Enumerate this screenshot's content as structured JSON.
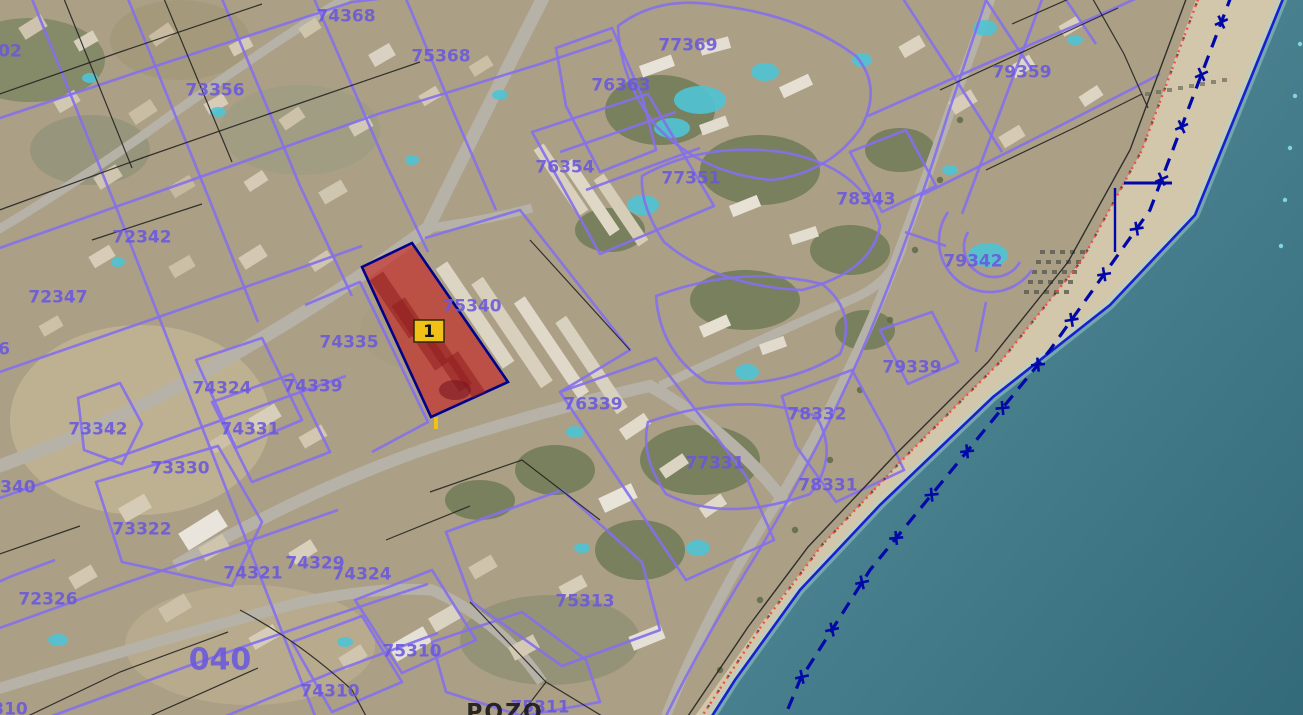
{
  "map": {
    "description": "Cadastral parcel map over aerial photo, coastal urban area",
    "marker": {
      "label": "1",
      "x": 429,
      "y": 331,
      "box_w": 30,
      "box_h": 22,
      "bg": "#f2c118",
      "border": "#2e2800",
      "text_color": "#111111"
    },
    "selected_parcel": {
      "number": "75340",
      "fill": "#c62020",
      "fill_opacity": 0.62,
      "border_color": "#00008b",
      "points": [
        [
          362,
          267
        ],
        [
          412,
          243
        ],
        [
          508,
          382
        ],
        [
          431,
          417
        ]
      ],
      "stem": [
        436,
        417,
        436,
        429
      ]
    },
    "labels": [
      {
        "text": "74368",
        "x": 346,
        "y": 15
      },
      {
        "text": "75368",
        "x": 441,
        "y": 55
      },
      {
        "text": "73356",
        "x": 215,
        "y": 89
      },
      {
        "text": "77369",
        "x": 688,
        "y": 44
      },
      {
        "text": "76363",
        "x": 621,
        "y": 84
      },
      {
        "text": "79359",
        "x": 1022,
        "y": 71
      },
      {
        "text": "72342",
        "x": 142,
        "y": 236
      },
      {
        "text": "72347",
        "x": 58,
        "y": 296
      },
      {
        "text": "76354",
        "x": 565,
        "y": 166
      },
      {
        "text": "77351",
        "x": 691,
        "y": 177
      },
      {
        "text": "78343",
        "x": 866,
        "y": 198
      },
      {
        "text": "79342",
        "x": 973,
        "y": 260
      },
      {
        "text": "75340",
        "x": 472,
        "y": 305
      },
      {
        "text": "74335",
        "x": 349,
        "y": 341
      },
      {
        "text": "74324",
        "x": 222,
        "y": 387
      },
      {
        "text": "74339",
        "x": 313,
        "y": 385
      },
      {
        "text": "79339",
        "x": 912,
        "y": 366
      },
      {
        "text": "76339",
        "x": 593,
        "y": 403
      },
      {
        "text": "78332",
        "x": 817,
        "y": 413
      },
      {
        "text": "73342",
        "x": 98,
        "y": 428
      },
      {
        "text": "74331",
        "x": 250,
        "y": 428
      },
      {
        "text": "77331",
        "x": 715,
        "y": 462
      },
      {
        "text": "78331",
        "x": 828,
        "y": 484
      },
      {
        "text": "73330",
        "x": 180,
        "y": 467
      },
      {
        "text": "73322",
        "x": 142,
        "y": 528
      },
      {
        "text": "72326",
        "x": 48,
        "y": 598
      },
      {
        "text": "74329",
        "x": 315,
        "y": 562
      },
      {
        "text": "74321",
        "x": 253,
        "y": 572
      },
      {
        "text": "74324",
        "x": 362,
        "y": 573
      },
      {
        "text": "75313",
        "x": 585,
        "y": 600
      },
      {
        "text": "040",
        "x": 220,
        "y": 658,
        "size": 30
      },
      {
        "text": "75310",
        "x": 412,
        "y": 650
      },
      {
        "text": "74310",
        "x": 330,
        "y": 690
      },
      {
        "text": "75311",
        "x": 540,
        "y": 706
      },
      {
        "text": "POZO",
        "x": 505,
        "y": 711,
        "color": "#161616",
        "size": 22,
        "spacing": 2
      },
      {
        "text": "02",
        "x": 10,
        "y": 50
      },
      {
        "text": "6",
        "x": 4,
        "y": 348
      },
      {
        "text": "2340",
        "x": 12,
        "y": 486
      },
      {
        "text": "310",
        "x": 10,
        "y": 708
      }
    ],
    "label_style": {
      "color": "#6a58dd",
      "size": 17,
      "opacity": 0.88
    },
    "coast": {
      "sea_color_deep": "#336a7a",
      "sea_color_shallow": "#5d95a2",
      "sand_color": "#d2c6ab",
      "waterline_color": "#1822cc",
      "waterline": "M1285,-6 L1195,215 L1110,305 L993,397 L880,505 L800,590 L735,680 L712,716",
      "sea_polygon": "M1285,-6 L1195,215 L1110,305 L993,397 L880,505 L800,590 L735,680 L712,716 L1308,716 L1308,-6 Z",
      "beach_polygon": "M1198,-6 L1285,-6 L1195,215 L1110,305 L993,397 L880,505 L800,590 L735,680 L712,716 L695,716 L760,625 L822,545 L907,455 L1002,360 L1082,260 L1142,150 Z",
      "maritime_boundary": "M1232,-6 L1150,210 L1050,350 L960,460 L870,570 L800,680 L785,716",
      "maritime_color": "#0008a8",
      "shore_red_dotted": "M1200,-6 L1142,150 L1082,260 L1002,360 L907,455 L822,545 L762,625 L702,716",
      "shore_red_color": "#f05048",
      "shore_black_line": "M1188,-6 L1130,150 L1068,262 L988,362 L893,457 L808,547 L748,627 L688,716",
      "t_mark_h": [
        1124,
        183,
        1172,
        183
      ],
      "t_mark_v": [
        1115,
        188,
        1115,
        252
      ],
      "cyan_dots": [
        [
          1300,
          44
        ],
        [
          1295,
          96
        ],
        [
          1290,
          148
        ],
        [
          1285,
          200
        ],
        [
          1281,
          246
        ]
      ]
    },
    "line_colors": {
      "cadastral_purple": "#8470ea",
      "parcel_black": "#1c1c1c"
    }
  }
}
